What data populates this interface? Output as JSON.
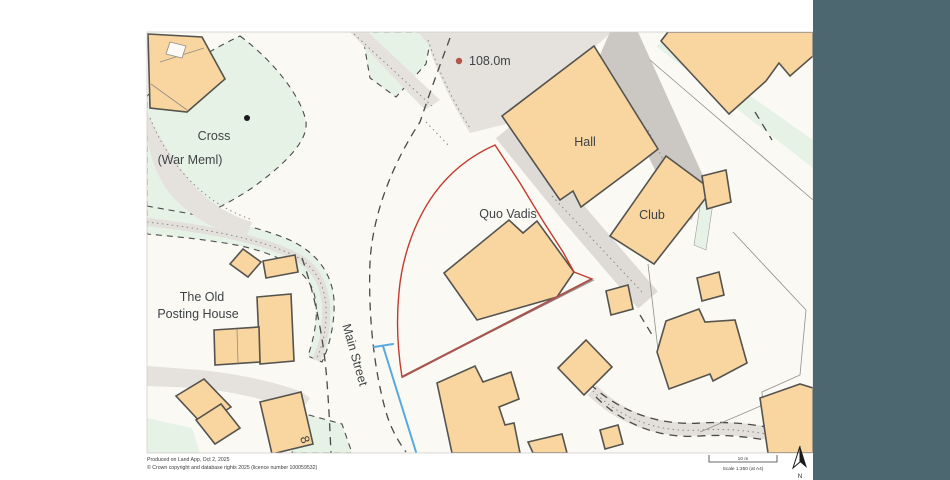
{
  "map": {
    "labels": {
      "hall": "Hall",
      "club": "Club",
      "quo_vadis": "Quo Vadis",
      "cross": "Cross",
      "war_meml": "(War Meml)",
      "old_posting_line1": "The Old",
      "old_posting_line2": "Posting House",
      "main_street": "Main Street",
      "house_number": "8",
      "spot_height": "108.0m"
    }
  },
  "footer": {
    "produced_on": "Produced on Land App, Oct 2, 2025",
    "copyright": "© Crown copyright and database rights 2025 (licence number 100059532)"
  },
  "scale_bar": {
    "distance_label": "10 m",
    "scale_label": "Scale 1:350 (at A4)"
  },
  "north": {
    "label": "N"
  },
  "colors": {
    "page_background": "#ffffff",
    "map_background": "#fbf9f3",
    "app_background": "#4d6770",
    "building_fill": "#f9d5a0",
    "building_stroke": "#55534e",
    "green_area": "#e7f2e6",
    "road_fill": "#e5e1dd",
    "road_dark": "#cbc7c3",
    "boundary_red": "#c23b2e",
    "water_blue": "#55aade",
    "label_text": "#3e4346",
    "spot_height_text": "#a8584a"
  }
}
